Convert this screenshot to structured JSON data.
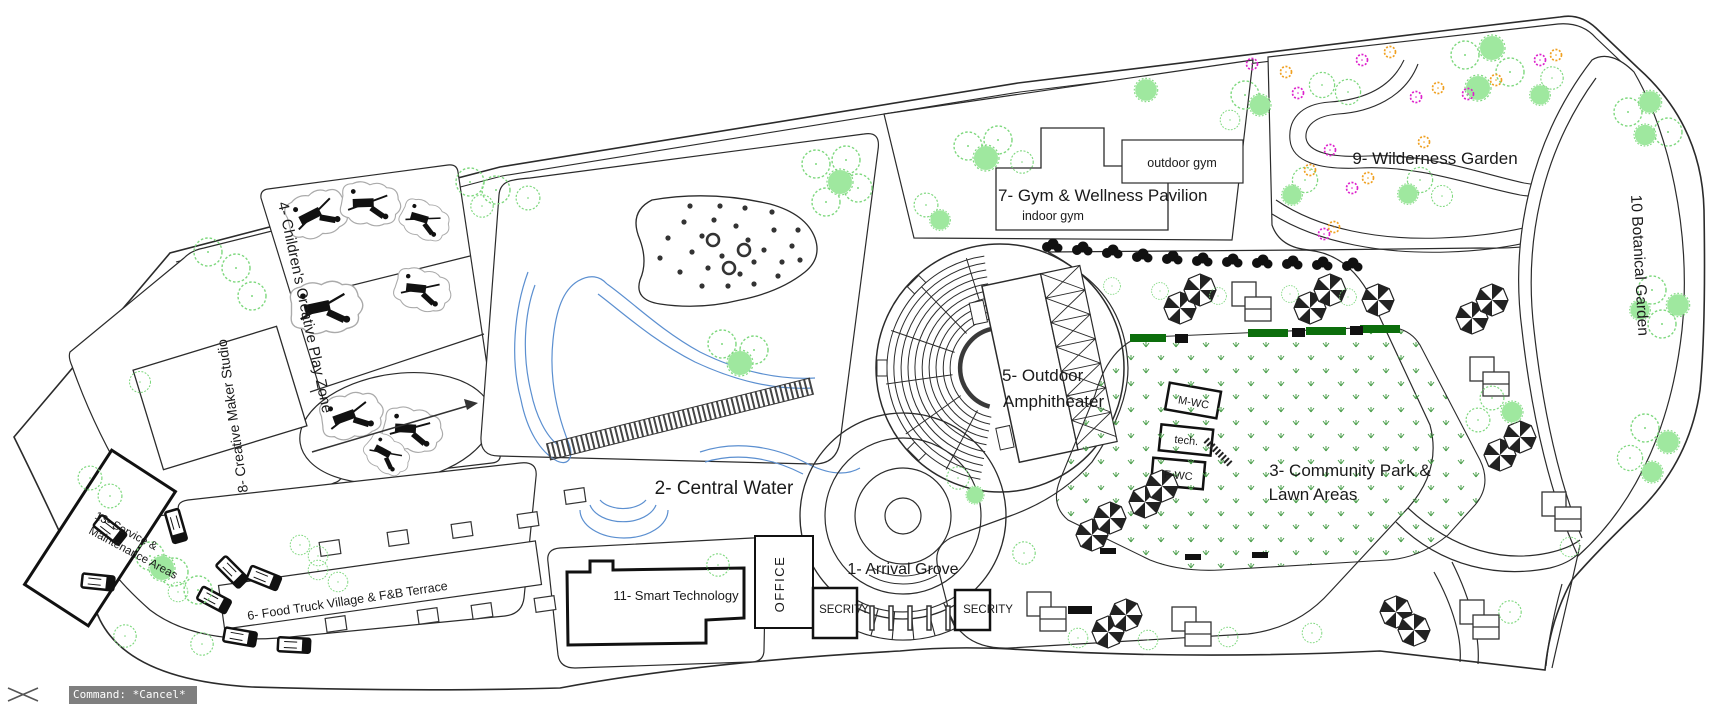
{
  "app": {
    "statusbar": {
      "command_text": "Command: *Cancel*"
    }
  },
  "zones": {
    "arrival": {
      "label": "1- Arrival Grove"
    },
    "central_water": {
      "label": "2- Central Water"
    },
    "community_park": {
      "label_line1": "3- Community Park &",
      "label_line2": "Lawn Areas"
    },
    "children_play": {
      "label": "4- Children's Creative Play Zone"
    },
    "amphitheater": {
      "label_line1": "5- Outdoor",
      "label_line2": "Amphitheater"
    },
    "food_truck": {
      "label": "6- Food Truck Village & F&B Terrace"
    },
    "gym": {
      "label": "7- Gym & Wellness Pavilion",
      "indoor_label": "indoor gym",
      "outdoor_label": "outdoor gym"
    },
    "maker_studio": {
      "label": "8- Creative Maker Studio"
    },
    "wilderness": {
      "label": "9- Wilderness Garden"
    },
    "botanical": {
      "label": "10 Botanical Garden"
    },
    "smart_tech": {
      "label": "11- Smart Technology"
    },
    "service": {
      "label_line1": "13- Service &",
      "label_line2": "Maintenance Areas"
    }
  },
  "buildings": {
    "office": "OFFICE",
    "security_left": "SECRITY",
    "security_right": "SECRITY",
    "wc_male": "M-WC",
    "wc_tech": "tech.",
    "wc_female": "F-WC"
  },
  "colors": {
    "line": "#2b2b2b",
    "tree_outline": "#7ed87e",
    "tree_fill": "#9fe89f",
    "grass": "#4a9e4a",
    "hedge": "#0c6e0c",
    "water": "#5b8fd0",
    "flower_magenta": "#dd22cc",
    "flower_orange": "#f0a020",
    "commandbar_bg": "#7f7f7f"
  }
}
